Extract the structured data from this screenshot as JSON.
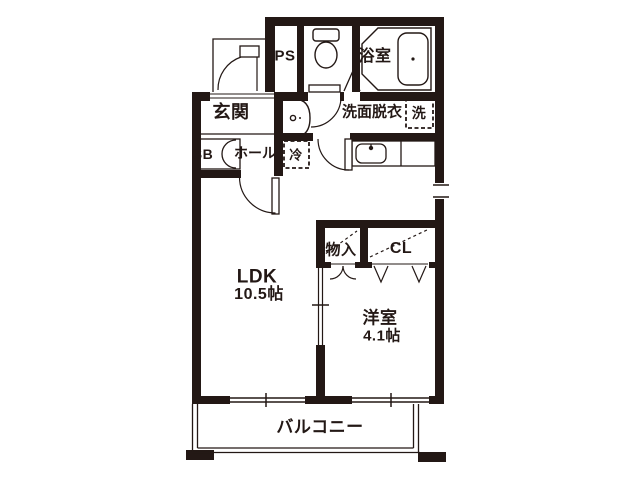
{
  "labels": {
    "ps": "PS",
    "bath": "浴室",
    "entrance": "玄関",
    "washroom": "洗面脱衣",
    "washing_machine": "洗",
    "shoe_box": "SB",
    "hall": "ホール",
    "refrigerator": "冷",
    "ldk": "LDK",
    "ldk_size": "10.5帖",
    "storage": "物入",
    "closet": "CL",
    "western_room": "洋室",
    "western_room_size": "4.1帖",
    "balcony": "バルコニー"
  },
  "colors": {
    "ink": "#231815",
    "background": "#ffffff"
  }
}
